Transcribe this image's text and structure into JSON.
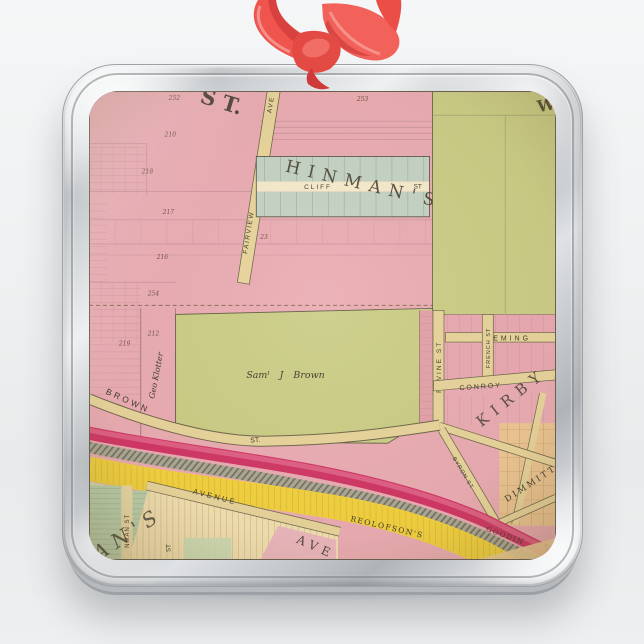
{
  "ornament": {
    "ribbon_color": "#ef554d",
    "frame_color": "#c9cdd0"
  },
  "map": {
    "colors": {
      "parcel_pink": "#e9abb4",
      "parcel_green": "#c9cd86",
      "lot_green": "#c2d2c6",
      "street_tan": "#e7d49c",
      "rail_magenta": "#cf3265",
      "canal_yellow": "#f2d23d",
      "hatch_gray": "#a8a594",
      "dimmitt_tan": "#ecc694",
      "ink": "#3b362a"
    },
    "labels": {
      "big_street": "S T.",
      "corner_w": "W",
      "corner_e": "E",
      "fairview": "FAIRVIEW",
      "fairview_ave": "AVE",
      "hinmans": "HINMAN'S",
      "cliff": "CLIFF",
      "cliff_st": "ST",
      "geo_klotter": "Geo Klotter",
      "saml_brown": "Samˡ J Brown",
      "brown": "BROWN",
      "brown_st": "ST.",
      "ravine_st": "RAVINE ST",
      "eming": "EMING",
      "french_st": "FRENCH ST",
      "conroy": "CONROY",
      "kirby": "KIRBY",
      "byron_st": "BYRON ST",
      "dimmitt": "DIMMITT",
      "goodin": "GOODIN",
      "avenue": "AVENUE",
      "reolofsons": "REOLOFSON'S",
      "ave_big": "AVE",
      "ans_script": "AN'S",
      "nman_st": "NMAN ST",
      "st_vertical": "ST"
    },
    "numbers": [
      "252",
      "253",
      "210",
      "218",
      "217",
      "216",
      "254",
      "212",
      "219",
      "23"
    ]
  }
}
